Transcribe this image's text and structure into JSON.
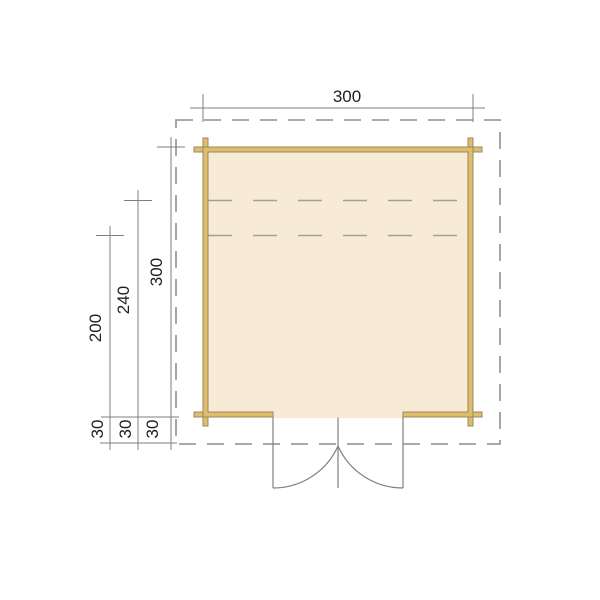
{
  "plan": {
    "type": "shed-floor-plan",
    "dim_top": {
      "label": "300"
    },
    "dims_left": [
      {
        "label": "300"
      },
      {
        "label": "240"
      },
      {
        "label": "200"
      }
    ],
    "dims_overhang": [
      {
        "label": "30"
      },
      {
        "label": "30"
      },
      {
        "label": "30"
      }
    ],
    "colors": {
      "floor_fill": "#f7ead7",
      "wall_fill": "#e0bd6c",
      "wall_stroke": "#97885c",
      "overhang_dash": "#9d9d9d",
      "interior_dash": "#a59f94",
      "dimension_line": "#7f7f7f",
      "dimension_text": "#1f1f1f",
      "door_line": "#808080"
    }
  }
}
